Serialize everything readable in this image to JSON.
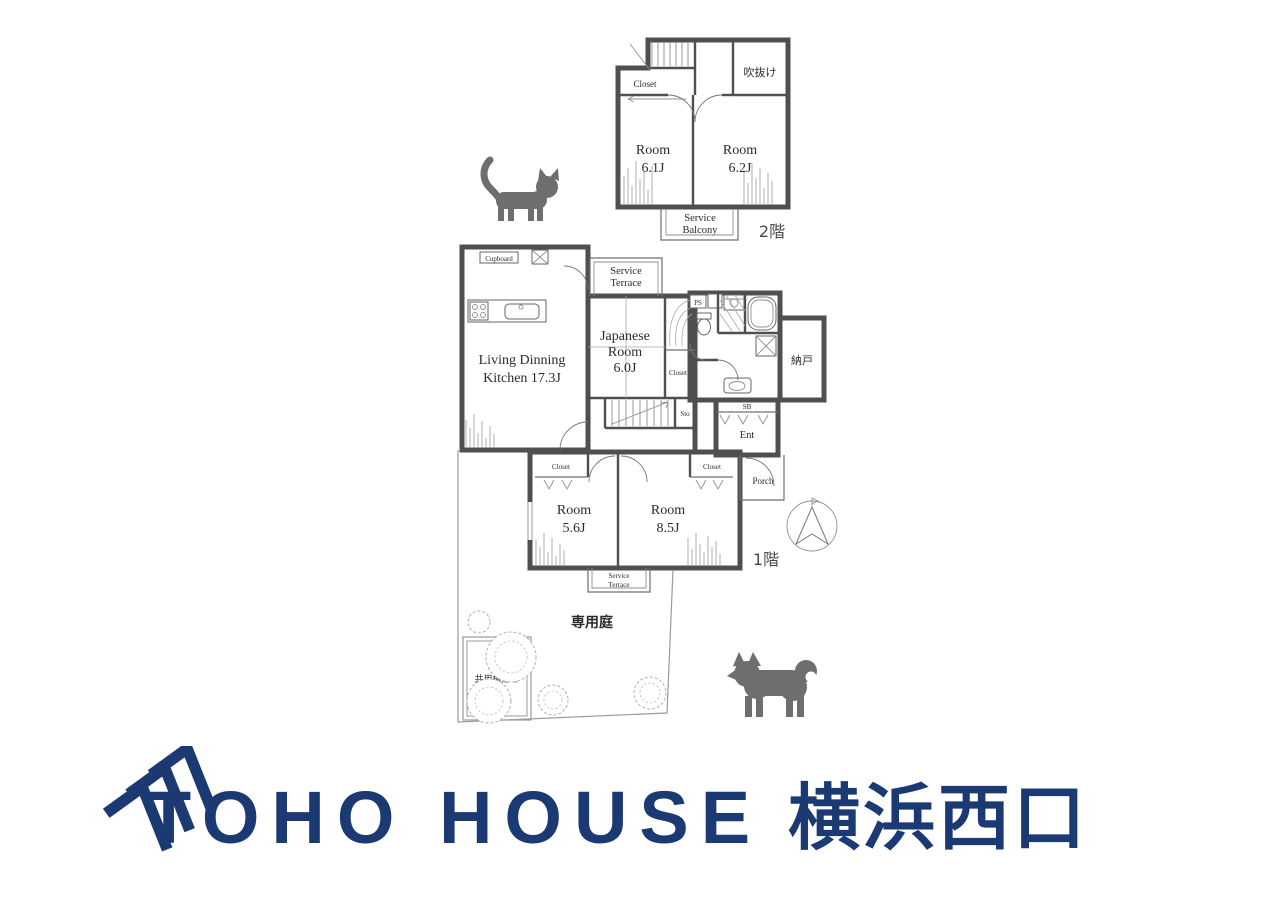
{
  "floor2": {
    "label": "2階",
    "void": "吹抜け",
    "closet": "Closet",
    "room_left": {
      "name": "Room",
      "size": "6.1J"
    },
    "room_right": {
      "name": "Room",
      "size": "6.2J"
    },
    "balcony": {
      "line1": "Service",
      "line2": "Balcony"
    }
  },
  "floor1": {
    "label": "1階",
    "cupboard": "Cupboard",
    "ldk": {
      "line1": "Living Dinning",
      "line2": "Kitchen 17.3J"
    },
    "terrace_top": {
      "line1": "Service",
      "line2": "Terrace"
    },
    "japanese_room": {
      "line1": "Japanese",
      "line2": "Room",
      "line3": "6.0J"
    },
    "jr_closet": "Closet",
    "sto": "Sto",
    "ps": "PS",
    "storage_room": "納戸",
    "shoe_box": "SB",
    "entrance": "Ent",
    "porch": "Porch",
    "room_small": {
      "name": "Room",
      "size": "5.6J",
      "closet": "Closet"
    },
    "room_large": {
      "name": "Room",
      "size": "8.5J",
      "closet": "Closet"
    },
    "terrace_bottom": {
      "line1": "Service",
      "line2": "Terrace"
    }
  },
  "garden": {
    "private_garden": "専用庭",
    "shared_planting": "共用植込み"
  },
  "logo": {
    "brand": "TOHO HOUSE",
    "branch": "横浜西口",
    "color": "#1b3a73"
  },
  "icons": {
    "cat": "cat-silhouette",
    "dog": "dog-silhouette",
    "compass": "north-compass"
  }
}
